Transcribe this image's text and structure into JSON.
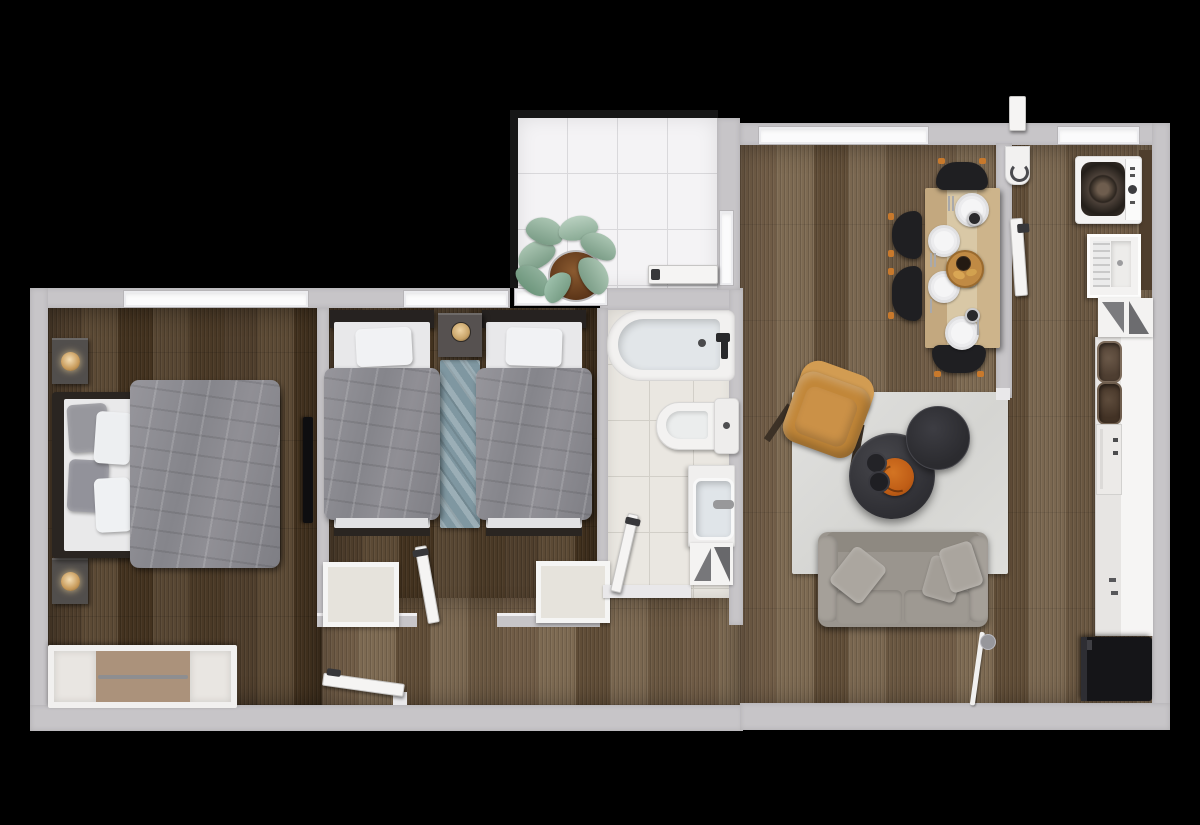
{
  "scene": {
    "type": "3d-floor-plan-top-view-render",
    "background": "#000000",
    "rooms": [
      {
        "name": "master-bedroom"
      },
      {
        "name": "second-bedroom-twin"
      },
      {
        "name": "bathroom"
      },
      {
        "name": "balcony"
      },
      {
        "name": "living-dining-room"
      },
      {
        "name": "kitchen-corridor"
      },
      {
        "name": "hallway"
      }
    ],
    "furniture": [
      "double-bed",
      "nightstand-with-lamp",
      "nightstand-with-lamp",
      "wardrobe",
      "wall-tv",
      "twin-bed",
      "twin-bed",
      "shared-nightstand-clock",
      "teal-runner-rug",
      "bedside-mat",
      "bedside-mat",
      "bathtub",
      "toilet",
      "sink-vanity",
      "towel-cabinet",
      "potted-plant",
      "dining-table-with-plates",
      "dining-chair",
      "dining-chair",
      "dining-chair",
      "dining-chair",
      "area-rug",
      "armchair",
      "coffee-table-large",
      "coffee-table-small",
      "orange-tray",
      "sofa",
      "floor-lamp",
      "washing-machine",
      "laundry-basin",
      "kitchen-counter",
      "double-sink",
      "oven",
      "fridge"
    ]
  },
  "colors": {
    "wall": "#c7c5c8",
    "window": "#fbfbfc",
    "railing": "#161616",
    "tileWhite": "#f4f3f5",
    "tileBeige": "#eae7e1",
    "plankD1": "#4f3e2c",
    "plankD2": "#5c4a35",
    "plankD3": "#43321f",
    "plankD4": "#584733",
    "plankD5": "#4a3926",
    "plankL1": "#705c46",
    "plankL2": "#7d6a52",
    "plankL3": "#604d37",
    "plankL4": "#7a6750",
    "plankL5": "#6a5741",
    "duvetGray": "#8e8e94",
    "sofaGray": "#9a958e",
    "rugGray": "#dcdcda",
    "armchairTan": "#c28739",
    "accentOrange": "#bf5d16",
    "tableWood": "#cbb392",
    "chairBlack": "#1f1f22",
    "runnerTeal": "#7f97a1",
    "fridgeBlack": "#151518"
  }
}
